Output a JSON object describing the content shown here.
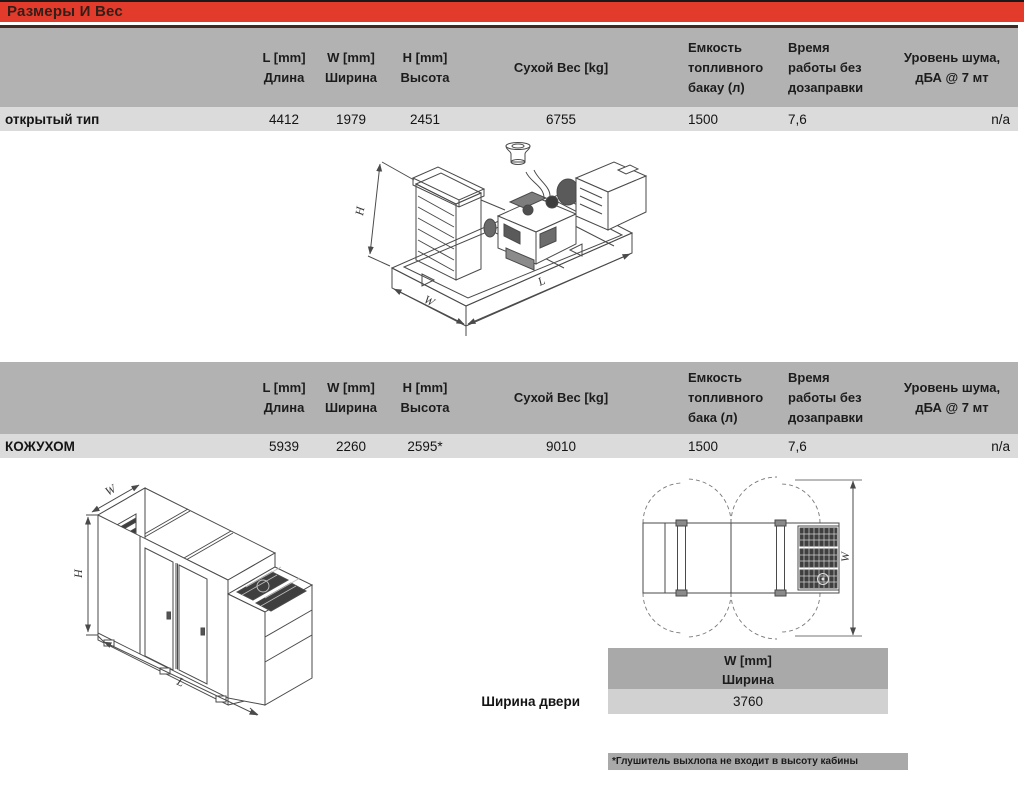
{
  "banner": {
    "title": "Размеры И Вес"
  },
  "tables": [
    {
      "header": {
        "col_l1": "L [mm]",
        "col_l2": "Длина",
        "col_w1": "W [mm]",
        "col_w2": "Ширина",
        "col_h1": "H [mm]",
        "col_h2": "Высота",
        "col_weight": "Сухой Вес [kg]",
        "col_fuel1": "Емкость",
        "col_fuel2": "топливного",
        "col_fuel3": "бакау (л)",
        "col_time1": "Время",
        "col_time2": "работы без",
        "col_time3": "дозаправки",
        "col_noise1": "Уровень шума,",
        "col_noise2": "дБА @ 7 мт"
      },
      "row": {
        "label": "открытый тип",
        "l": "4412",
        "w": "1979",
        "h": "2451",
        "weight": "6755",
        "fuel": "1500",
        "time": "7,6",
        "noise": "n/a"
      }
    },
    {
      "header": {
        "col_l1": "L [mm]",
        "col_l2": "Длина",
        "col_w1": "W [mm]",
        "col_w2": "Ширина",
        "col_h1": "H [mm]",
        "col_h2": "Высота",
        "col_weight": "Сухой Вес [kg]",
        "col_fuel1": "Емкость",
        "col_fuel2": "топливного",
        "col_fuel3": "бака (л)",
        "col_time1": "Время",
        "col_time2": "работы без",
        "col_time3": "дозаправки",
        "col_noise1": "Уровень шума,",
        "col_noise2": "дБА @ 7 мт"
      },
      "row": {
        "label": "КОЖУХОМ",
        "l": "5939",
        "w": "2260",
        "h": "2595*",
        "weight": "9010",
        "fuel": "1500",
        "time": "7,6",
        "noise": "n/a"
      }
    }
  ],
  "door_table": {
    "label": "Ширина двери",
    "header1": "W [mm]",
    "header2": "Ширина",
    "value": "3760"
  },
  "footnote": "*Глушитель выхлопа не входит в высоту кабины",
  "drawings": {
    "open_type": {
      "h_label": "H",
      "w_label": "W",
      "l_label": "L"
    },
    "canopy": {
      "h_label": "H",
      "w_label": "W",
      "l_label": "L"
    },
    "top_view": {
      "w_label": "W"
    }
  },
  "colors": {
    "banner_red": "#e23b2c",
    "banner_text": "#331e18",
    "table_header_gray": "#b2b2b2",
    "table_row_gray": "#dbdbdb",
    "door_header_gray": "#a9a9a9",
    "door_value_gray": "#d1d1d1",
    "footnote_gray": "#a9a9a9",
    "dark_rule": "#402a23",
    "line_art": "#4a4a4a"
  }
}
